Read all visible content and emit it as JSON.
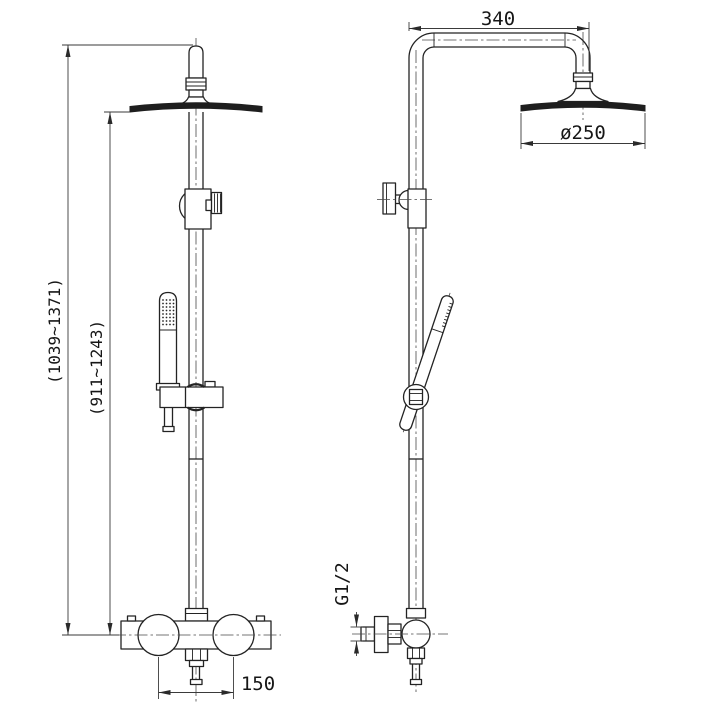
{
  "title": "shower-column-technical-drawing",
  "colors": {
    "background": "#ffffff",
    "line": "#232323"
  },
  "views": {
    "front_label": "front-view",
    "side_label": "side-view"
  },
  "dimensions": {
    "arm_length": "340",
    "head_diameter": "ø250",
    "overall_height_range": "(1039~1371)",
    "riser_height_range": "(911~1243)",
    "outlet_spacing": "150",
    "inlet_thread": "G1/2"
  }
}
